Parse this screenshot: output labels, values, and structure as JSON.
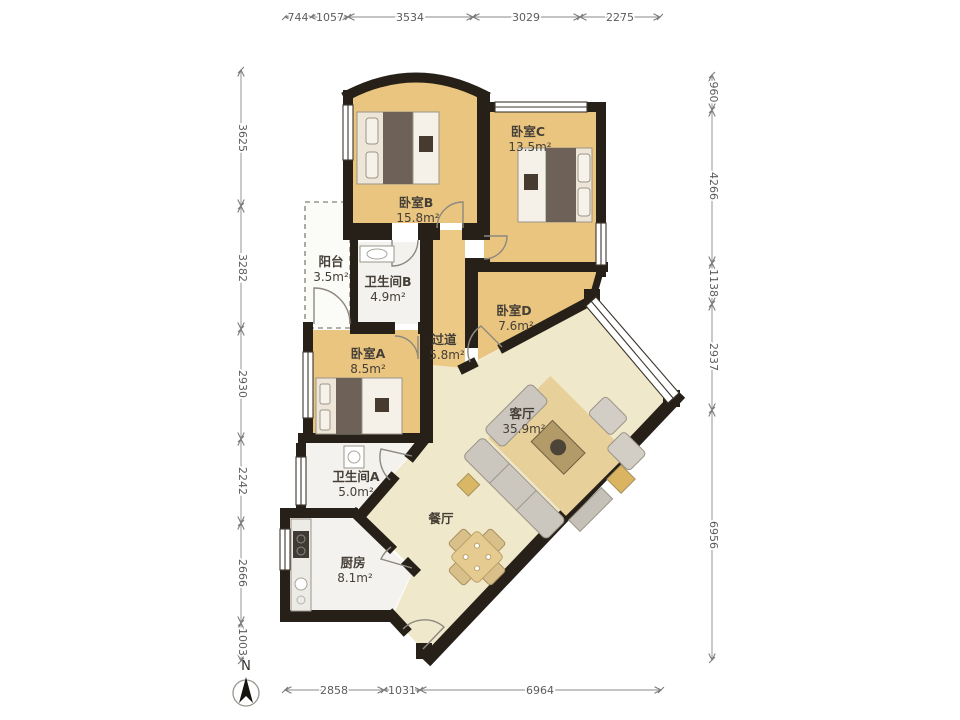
{
  "rooms": {
    "bedroom_b": {
      "name": "卧室B",
      "area": "15.8m²"
    },
    "bedroom_c": {
      "name": "卧室C",
      "area": "13.5m²"
    },
    "bedroom_d": {
      "name": "卧室D",
      "area": "7.6m²"
    },
    "bedroom_a": {
      "name": "卧室A",
      "area": "8.5m²"
    },
    "balcony": {
      "name": "阳台",
      "area": "3.5m²"
    },
    "bathroom_b": {
      "name": "卫生间B",
      "area": "4.9m²"
    },
    "corridor": {
      "name": "过道",
      "area": "5.8m²"
    },
    "living_room": {
      "name": "客厅",
      "area": "35.9m²"
    },
    "bathroom_a": {
      "name": "卫生间A",
      "area": "5.0m²"
    },
    "kitchen": {
      "name": "厨房",
      "area": "8.1m²"
    },
    "dining_room": {
      "name": "餐厅"
    }
  },
  "dimensions": {
    "top": [
      "744",
      "1057",
      "3534",
      "3029",
      "2275"
    ],
    "left": [
      "3625",
      "3282",
      "2930",
      "2242",
      "2666",
      "1003"
    ],
    "right": [
      "960",
      "4266",
      "1138",
      "2937",
      "6956"
    ],
    "bottom": [
      "2858",
      "1031",
      "6964"
    ]
  },
  "compass": {
    "label": "N"
  },
  "colors": {
    "floor_bedroom": "#e9c57f",
    "floor_living": "#f0e8ca",
    "floor_wet": "#f3f2ee",
    "wall": "#262019",
    "dim_text": "#5c5c5c"
  }
}
